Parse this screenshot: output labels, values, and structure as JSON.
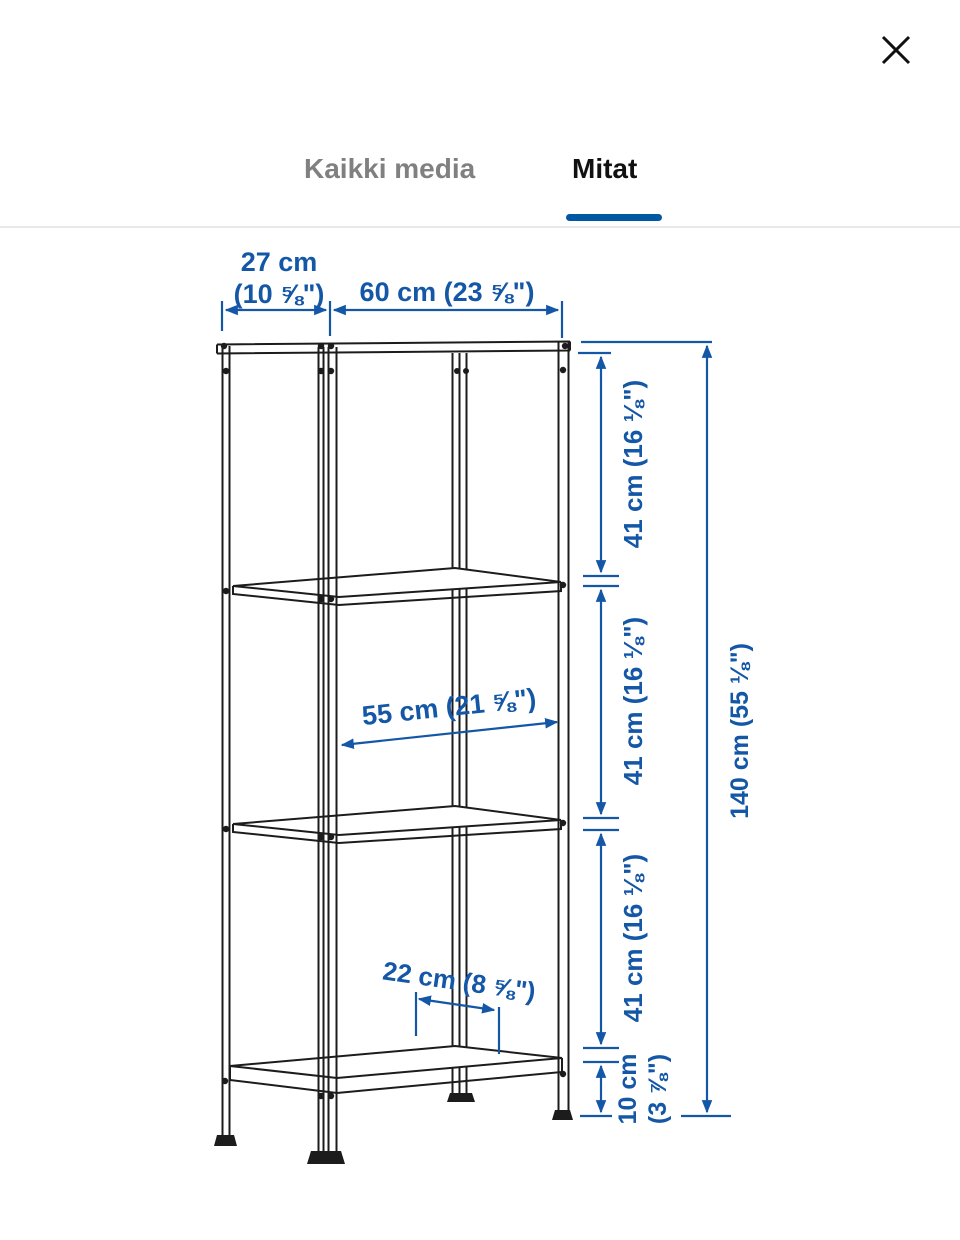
{
  "header": {
    "tabs": [
      {
        "label": "Kaikki media",
        "active": false
      },
      {
        "label": "Mitat",
        "active": true
      }
    ]
  },
  "colors": {
    "accent_blue": "#0058a3",
    "dimension_blue": "#1457a6",
    "line_black": "#1c1c1c",
    "tab_inactive_gray": "#808080",
    "divider_gray": "#e9e9e9"
  },
  "diagram": {
    "labels": {
      "depth_cm": "27 cm",
      "depth_in": "(10 ⅝\")",
      "width": "60 cm (23 ⅝\")",
      "inner_width": "55 cm (21 ⅝\")",
      "shelf_clear_depth": "22 cm (8 ⅝\")",
      "shelf_spacing": "41 cm (16 ⅛\")",
      "height": "140 cm (55 ⅛\")",
      "bottom_clearance_cm": "10 cm",
      "bottom_clearance_in": "(3 ⅞\")"
    }
  }
}
